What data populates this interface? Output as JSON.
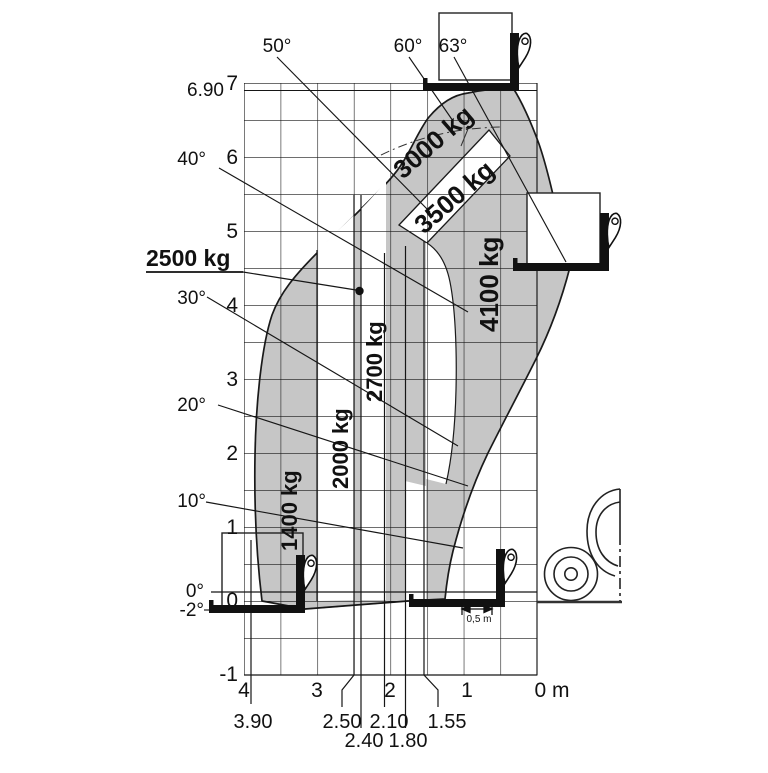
{
  "axes": {
    "y_ticks": [
      "7",
      "6",
      "5",
      "4",
      "3",
      "2",
      "1",
      "0",
      "-1"
    ],
    "y_max_height": "6.90",
    "x_ticks": [
      "4",
      "3",
      "2",
      "1",
      "0 m"
    ],
    "reach_row1": [
      "3.90",
      "2.50",
      "2.10",
      "1.55"
    ],
    "reach_row2": [
      "2.40",
      "1.80"
    ]
  },
  "angles": {
    "deg50": "50°",
    "deg60": "60°",
    "deg63": "63°",
    "deg40": "40°",
    "deg30": "30°",
    "deg20": "20°",
    "deg10": "10°",
    "deg0": "0°",
    "degm2": "-2°"
  },
  "loads": {
    "z1400": "1400 kg",
    "z2000": "2000 kg",
    "z2500": "2500 kg",
    "z2700": "2700 kg",
    "z3000": "3000 kg",
    "z3500": "3500 kg",
    "z4100": "4100 kg"
  },
  "dimension": {
    "min_reach": "0,5 m"
  },
  "colors": {
    "zone_grey": "#c6c6c6",
    "line": "#1a1a1a",
    "background": "#ffffff"
  },
  "chart_data": {
    "type": "area",
    "title": "Telehandler load capacity envelope chart",
    "xlabel": "reach (m), reversed axis 4 to 0",
    "ylabel": "lift height (m)",
    "x_ticks": [
      4,
      3,
      2,
      1,
      0
    ],
    "y_ticks": [
      -1,
      0,
      1,
      2,
      3,
      4,
      5,
      6,
      7
    ],
    "grid": true,
    "max_lift_height_m": 6.9,
    "boom_angle_lines_deg": [
      -2,
      0,
      10,
      20,
      30,
      40,
      50,
      60,
      63
    ],
    "reach_boundaries_m": [
      3.9,
      2.5,
      2.4,
      2.1,
      1.8,
      1.55
    ],
    "min_reach_dimension": "0,5 m",
    "capacity_zones": [
      {
        "capacity_kg": 1400,
        "reach_m": [
          3.0,
          3.9
        ],
        "shaded": true
      },
      {
        "capacity_kg": 2000,
        "reach_m": [
          2.5,
          3.0
        ],
        "shaded": false
      },
      {
        "capacity_kg": 2500,
        "reach_m": [
          2.4,
          2.5
        ],
        "shaded": true,
        "marker": "dot at ~4.2 m height"
      },
      {
        "capacity_kg": 2700,
        "reach_m": [
          2.1,
          2.4
        ],
        "shaded": false
      },
      {
        "capacity_kg": 3000,
        "zone": "upper diagonal band near max height",
        "shaded": true
      },
      {
        "capacity_kg": 3500,
        "zone": "diagonal band below 3000 kg band",
        "shaded": false
      },
      {
        "capacity_kg": 4100,
        "reach_m": [
          0.5,
          1.55
        ],
        "shaded": true
      }
    ]
  }
}
